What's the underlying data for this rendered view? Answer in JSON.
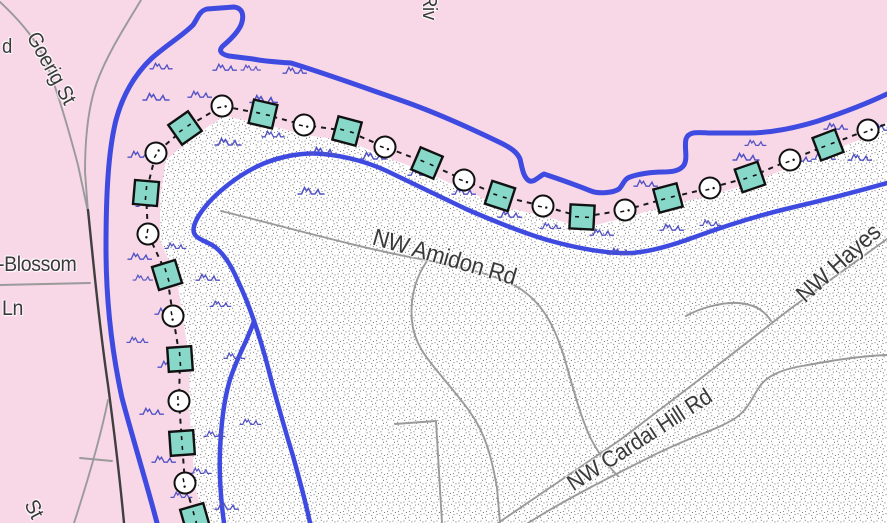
{
  "map": {
    "colors": {
      "background_pink": "#f8d7e7",
      "flood_zone_fill": "#ffffff",
      "stipple_dot": "#454545",
      "river_blue": "#3e4ae0",
      "wave_blue": "#5252c4",
      "road_minor": "#9a9a9a",
      "road_major": "#3f3f3f",
      "levee_square_fill": "#87d8c8",
      "levee_outline": "#111111",
      "label_text": "#3a3a3a"
    },
    "labels": [
      {
        "name": "road-label-rd-partial",
        "text": "d",
        "x": 2,
        "y": 36,
        "rot": 0,
        "size": 20
      },
      {
        "name": "road-label-goerig-st",
        "text": "Goerig St",
        "x": 42,
        "y": 28,
        "rot": 61,
        "size": 21
      },
      {
        "name": "road-label-blossom",
        "text": "-Blossom",
        "x": -2,
        "y": 253,
        "rot": 0,
        "size": 21
      },
      {
        "name": "road-label-ln",
        "text": "Ln",
        "x": 2,
        "y": 297,
        "rot": 0,
        "size": 21
      },
      {
        "name": "road-label-riv",
        "text": "Riv",
        "x": 440,
        "y": -6,
        "rot": 90,
        "size": 20
      },
      {
        "name": "road-label-nw-amidon-rd",
        "text": "NW Amidon Rd",
        "x": 377,
        "y": 224,
        "rot": 16,
        "size": 24
      },
      {
        "name": "road-label-nw-cardai-hill-rd",
        "text": "NW Cardai Hill Rd",
        "x": 562,
        "y": 474,
        "rot": -33,
        "size": 23
      },
      {
        "name": "road-label-nw-hayes",
        "text": "NW Hayes",
        "x": 791,
        "y": 288,
        "rot": -42,
        "size": 24
      },
      {
        "name": "road-label-st-partial",
        "text": "St",
        "x": 40,
        "y": 496,
        "rot": 63,
        "size": 21
      }
    ],
    "flood_zone_outline": "M887,122 L870,136 L830,151 L792,166 L752,183 L712,195 L670,205 L627,217 L584,228 L544,216 L500,206 L465,190 L428,173 L386,157 L348,141 L305,135 L264,124 L224,116 L194,136 L166,160 L160,198 L160,240 L177,280 L183,320 L190,362 L189,404 L192,446 L195,486 L205,523 L887,523 Z",
    "river_lines": [
      {
        "name": "river-outer-bank",
        "d": "M157,523 C148,488 132,436 122,398 C112,352 106,302 106,248 C106,196 108,152 116,120 C123,94 135,74 152,58 C168,44 182,36 193,25 C198,18 199,11 207,9 L234,7 C242,8 244,14 242,22 C240,30 231,39 224,45 C218,50 220,54 229,56 L253,59 C268,62 280,62 291,63 C330,75 368,89 400,100 C432,111 470,128 501,143 C511,148 517,152 520,159 C522,167 523,176 528,180 C533,184 538,177 544,174 C556,178 576,185 591,191 C599,194 613,193 619,189 C623,185 624,179 630,177 C638,174 652,172 662,172 C672,172 680,171 684,165 C688,158 684,147 686,139 C689,130 700,133 712,133 L748,133 C770,133 795,128 818,121 C842,113 866,104 887,94",
        "width": 5
      },
      {
        "name": "river-inner-bank",
        "d": "M887,183 C855,192 820,201 790,208 C756,216 722,227 692,238 C670,246 648,252 631,253 C606,254 577,248 551,241 C526,234 496,222 466,209 C441,197 416,185 391,173 C371,163 346,156 323,154 C301,152 276,157 256,167 C236,177 216,193 205,207 C197,217 192,227 194,233 C197,240 207,241 215,247 C223,253 231,265 238,281 C245,296 250,309 254,321 C260,338 267,363 272,383 C278,405 286,433 293,456 C299,478 306,503 310,523",
        "width": 4.5
      },
      {
        "name": "river-inner-branch",
        "d": "M254,321 C247,342 235,361 229,383 C224,401 221,426 220,451 C219,476 221,501 224,523",
        "width": 4.5
      }
    ],
    "roads": [
      {
        "name": "road-upper-left",
        "kind": "minor",
        "d": "M0,2 C15,16 30,32 40,50 C52,72 66,120 78,165 L88,212"
      },
      {
        "name": "road-goerig-st",
        "kind": "minor",
        "d": "M141,0 C128,22 108,52 97,82 C88,107 85,140 85,172 L88,212"
      },
      {
        "name": "road-dark-south",
        "kind": "major",
        "d": "M88,210 C94,270 100,330 108,385 C114,430 120,480 124,523"
      },
      {
        "name": "road-branch-sw",
        "kind": "minor",
        "d": "M108,400 C100,440 88,480 74,523"
      },
      {
        "name": "road-branch-connector",
        "kind": "minor",
        "d": "M80,458 L112,461"
      },
      {
        "name": "road-blossom-ln",
        "kind": "minor",
        "d": "M0,285 L90,283"
      },
      {
        "name": "road-nw-amidon",
        "kind": "minor",
        "d": "M221,211 C290,228 360,248 420,259 C470,268 505,278 522,290 C545,306 556,330 565,360 C573,388 580,415 590,437 C598,453 608,466 618,476"
      },
      {
        "name": "road-mid-vertical",
        "kind": "minor",
        "d": "M427,261 C414,280 410,300 412,321 C414,345 429,361 443,378 C457,395 470,410 478,425 C488,443 493,465 497,488 L500,523"
      },
      {
        "name": "road-hook",
        "kind": "minor",
        "d": "M395,424 L436,421 C438,450 440,485 442,523"
      },
      {
        "name": "road-nw-cardai-hill",
        "kind": "minor",
        "d": "M528,523 C568,498 612,476 652,456 C690,437 716,430 734,419 C748,410 752,398 758,389 C765,377 779,370 802,366 C830,361 858,356 887,355"
      },
      {
        "name": "road-nw-hayes",
        "kind": "minor",
        "d": "M498,523 L620,440 L700,379 L790,309 L887,239"
      },
      {
        "name": "road-loop-branch",
        "kind": "minor",
        "d": "M686,316 C700,308 722,302 738,303 C754,304 764,310 771,321"
      }
    ],
    "levee": {
      "extension_points": "195,518 200,523",
      "tail_points": "868,130 887,124",
      "symbols": [
        {
          "t": "sq",
          "x": 195,
          "y": 518,
          "r": 74
        },
        {
          "t": "ci",
          "x": 185,
          "y": 483,
          "r": 80
        },
        {
          "t": "sq",
          "x": 182,
          "y": 443,
          "r": 86
        },
        {
          "t": "ci",
          "x": 179,
          "y": 401,
          "r": 88
        },
        {
          "t": "sq",
          "x": 180,
          "y": 359,
          "r": 86
        },
        {
          "t": "ci",
          "x": 173,
          "y": 316,
          "r": 80
        },
        {
          "t": "sq",
          "x": 167,
          "y": 275,
          "r": 73
        },
        {
          "t": "ci",
          "x": 148,
          "y": 234,
          "r": 100
        },
        {
          "t": "sq",
          "x": 146,
          "y": 193,
          "r": 95
        },
        {
          "t": "ci",
          "x": 156,
          "y": 153,
          "r": -59
        },
        {
          "t": "sq",
          "x": 185,
          "y": 128,
          "r": -35
        },
        {
          "t": "ci",
          "x": 222,
          "y": 106,
          "r": -10
        },
        {
          "t": "sq",
          "x": 263,
          "y": 114,
          "r": 13
        },
        {
          "t": "ci",
          "x": 304,
          "y": 125,
          "r": 11
        },
        {
          "t": "sq",
          "x": 347,
          "y": 131,
          "r": 15
        },
        {
          "t": "ci",
          "x": 385,
          "y": 147,
          "r": 20
        },
        {
          "t": "sq",
          "x": 427,
          "y": 163,
          "r": 23
        },
        {
          "t": "ci",
          "x": 464,
          "y": 180,
          "r": 20
        },
        {
          "t": "sq",
          "x": 500,
          "y": 196,
          "r": 18
        },
        {
          "t": "ci",
          "x": 543,
          "y": 206,
          "r": 10
        },
        {
          "t": "sq",
          "x": 582,
          "y": 217,
          "r": 3
        },
        {
          "t": "ci",
          "x": 625,
          "y": 210,
          "r": -11
        },
        {
          "t": "sq",
          "x": 668,
          "y": 198,
          "r": -15
        },
        {
          "t": "ci",
          "x": 710,
          "y": 188,
          "r": -14
        },
        {
          "t": "sq",
          "x": 750,
          "y": 177,
          "r": -19
        },
        {
          "t": "ci",
          "x": 790,
          "y": 160,
          "r": -20
        },
        {
          "t": "sq",
          "x": 828,
          "y": 145,
          "r": -21
        },
        {
          "t": "ci",
          "x": 868,
          "y": 130,
          "r": -21
        }
      ]
    },
    "waves": [
      {
        "x": 143,
        "y": 92,
        "s": 1.0
      },
      {
        "x": 188,
        "y": 90,
        "s": 0.9
      },
      {
        "x": 250,
        "y": 94,
        "s": 1.05
      },
      {
        "x": 150,
        "y": 62,
        "s": 0.85
      },
      {
        "x": 213,
        "y": 63,
        "s": 0.9
      },
      {
        "x": 241,
        "y": 64,
        "s": 0.75
      },
      {
        "x": 283,
        "y": 66,
        "s": 0.9
      },
      {
        "x": 128,
        "y": 150,
        "s": 0.9
      },
      {
        "x": 136,
        "y": 200,
        "s": 0.8
      },
      {
        "x": 128,
        "y": 252,
        "s": 0.9
      },
      {
        "x": 133,
        "y": 274,
        "s": 0.75
      },
      {
        "x": 155,
        "y": 307,
        "s": 0.9
      },
      {
        "x": 127,
        "y": 336,
        "s": 0.8
      },
      {
        "x": 158,
        "y": 360,
        "s": 0.9
      },
      {
        "x": 140,
        "y": 407,
        "s": 0.9
      },
      {
        "x": 152,
        "y": 455,
        "s": 0.9
      },
      {
        "x": 171,
        "y": 491,
        "s": 0.8
      },
      {
        "x": 215,
        "y": 137,
        "s": 1.0
      },
      {
        "x": 262,
        "y": 130,
        "s": 0.85
      },
      {
        "x": 310,
        "y": 146,
        "s": 1.0
      },
      {
        "x": 360,
        "y": 151,
        "s": 1.0
      },
      {
        "x": 298,
        "y": 186,
        "s": 1.0
      },
      {
        "x": 408,
        "y": 168,
        "s": 0.9
      },
      {
        "x": 452,
        "y": 187,
        "s": 0.9
      },
      {
        "x": 498,
        "y": 210,
        "s": 0.9
      },
      {
        "x": 540,
        "y": 222,
        "s": 0.8
      },
      {
        "x": 590,
        "y": 228,
        "s": 0.9
      },
      {
        "x": 634,
        "y": 179,
        "s": 0.9
      },
      {
        "x": 608,
        "y": 247,
        "s": 0.9
      },
      {
        "x": 660,
        "y": 223,
        "s": 0.9
      },
      {
        "x": 700,
        "y": 219,
        "s": 0.8
      },
      {
        "x": 733,
        "y": 152,
        "s": 1.0
      },
      {
        "x": 745,
        "y": 139,
        "s": 0.8
      },
      {
        "x": 788,
        "y": 154,
        "s": 0.9
      },
      {
        "x": 812,
        "y": 152,
        "s": 0.9
      },
      {
        "x": 848,
        "y": 153,
        "s": 0.9
      },
      {
        "x": 824,
        "y": 122,
        "s": 0.9
      },
      {
        "x": 872,
        "y": 123,
        "s": 0.9
      },
      {
        "x": 165,
        "y": 242,
        "s": 0.8
      },
      {
        "x": 196,
        "y": 273,
        "s": 0.9
      },
      {
        "x": 210,
        "y": 300,
        "s": 0.8
      },
      {
        "x": 224,
        "y": 352,
        "s": 0.8
      },
      {
        "x": 204,
        "y": 430,
        "s": 0.8
      },
      {
        "x": 240,
        "y": 418,
        "s": 0.8
      },
      {
        "x": 190,
        "y": 467,
        "s": 0.8
      },
      {
        "x": 215,
        "y": 502,
        "s": 0.9
      }
    ]
  }
}
